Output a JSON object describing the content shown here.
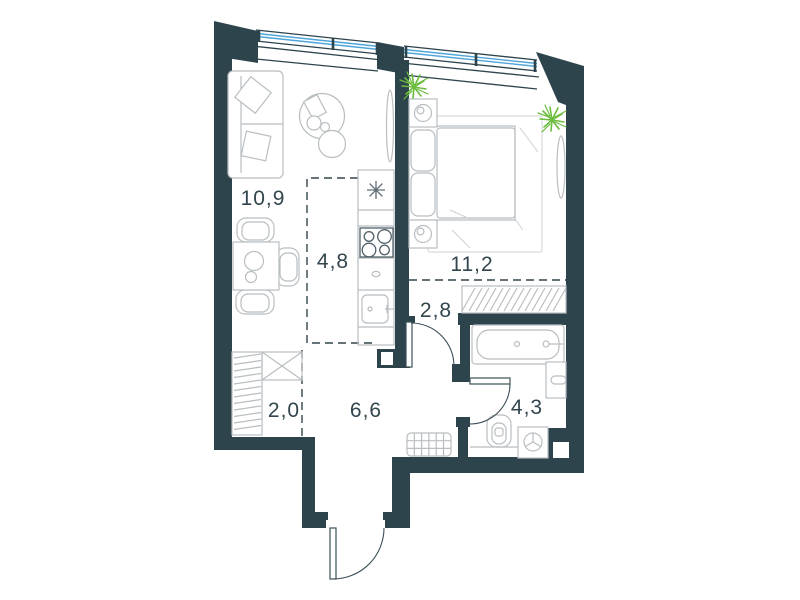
{
  "plan": {
    "type": "apartment-floor-plan",
    "rooms": [
      {
        "id": "living-room",
        "area_label": "10,9"
      },
      {
        "id": "kitchen",
        "area_label": "4,8"
      },
      {
        "id": "bedroom",
        "area_label": "11,2"
      },
      {
        "id": "hall",
        "area_label": "2,8"
      },
      {
        "id": "entry-hall",
        "area_label": "6,6"
      },
      {
        "id": "wardrobe",
        "area_label": "2,0"
      },
      {
        "id": "bathroom",
        "area_label": "4,3"
      }
    ],
    "colors": {
      "wall": "#2e444d",
      "window_glass": "#4fa5da",
      "plant": "#6cbc3d",
      "furniture_line": "#b9bec1",
      "label_text": "#33454d",
      "background": "#ffffff"
    },
    "icons": [
      "window-glazing-icon",
      "sofa-icon",
      "pillow-icon",
      "coffee-table-icon",
      "magazine-icon",
      "dining-table-icon",
      "chair-icon",
      "tv-icon",
      "kitchen-counter-icon",
      "hood-asterisk-icon",
      "stove-icon",
      "kitchen-sink-icon",
      "bed-icon",
      "nightstand-lamp-icon",
      "plant-icon",
      "mirror-icon",
      "rug-icon",
      "closet-rail-icon",
      "wardrobe-x-icon",
      "bedroom-closet-hatch-icon",
      "bathtub-icon",
      "washbasin-icon",
      "toilet-icon",
      "washing-machine-icon",
      "doormat-icon",
      "door-swing-icon",
      "entrance-door-icon",
      "shaft-notch-icon"
    ]
  }
}
